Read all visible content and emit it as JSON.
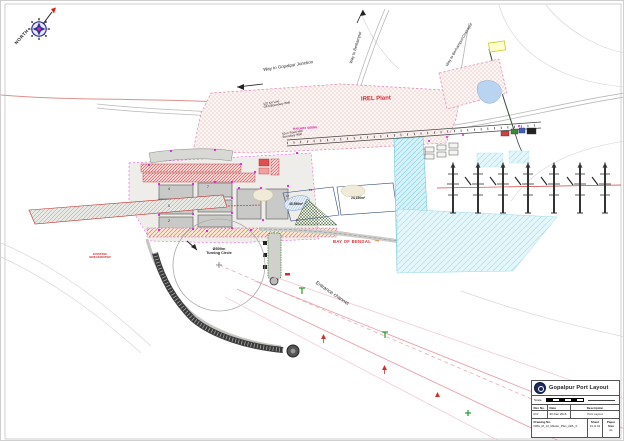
{
  "compass": {
    "label": "NORTH"
  },
  "roads": {
    "gopalpur_junction": "Way to Gopalpur Junction",
    "berhampur": "Way to Berhampur",
    "berhampur_chatrapur": "Way to Berhampur/Chatrapur"
  },
  "plant": {
    "name": "IREL Plant",
    "kv_note_line1": "132 KV Line",
    "kv_note_line2": "OFC/Boundary Wall",
    "road_note_line1": "50 m Road with",
    "road_note_line2": "Boundary Wall",
    "railway_siding": "RAILWAY SIDING"
  },
  "yard": {
    "blocks": [
      {
        "no": "4"
      },
      {
        "no": "7"
      },
      {
        "no": "5"
      },
      {
        "no": "2"
      }
    ]
  },
  "parcels": {
    "no_a": "17",
    "no_b": "14",
    "area_a": "45,556m²",
    "area_b": "24,150m²"
  },
  "marine": {
    "turning_circle_dia": "Ø500m",
    "turning_circle": "Turning Circle",
    "entrance_channel": "Entrance channel",
    "bay": "BAY OF BENGAL",
    "breakwater_line1": "EXISTING",
    "breakwater_line2": "BREAKWATER"
  },
  "titleblock": {
    "title": "Gopalpur Port Layout",
    "scale_label": "Scale",
    "rev_no_header": "Rev No.",
    "date_header": "Date",
    "description_header": "Description",
    "rev_no": "R-0",
    "date": "30 Dec 2016",
    "description": "Port Layout",
    "drawing_no_label": "Drawing No.",
    "drawing_no": "DRG_M_13_Master_Plan_GPL_0",
    "sheet_label": "Sheet",
    "sheet": "01 of 01",
    "paper_label": "Paper Size",
    "paper": "A1"
  }
}
